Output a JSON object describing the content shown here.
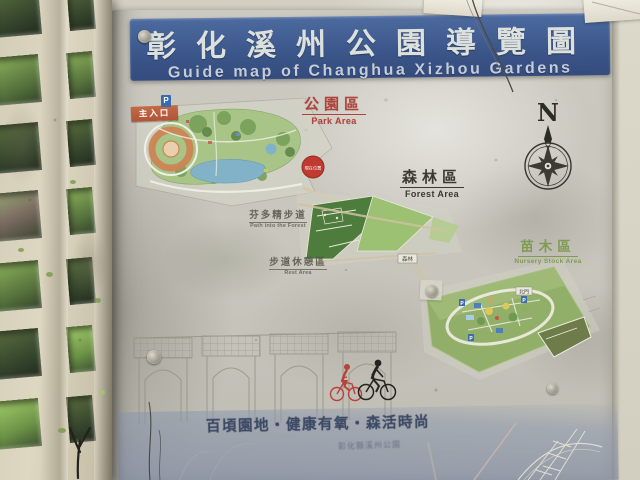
{
  "sign": {
    "title_zh": "彰化溪州公園導覽圖",
    "title_en": "Guide map of Changhua Xizhou Gardens"
  },
  "areas": {
    "park": {
      "zh": "公園區",
      "en": "Park Area"
    },
    "forest": {
      "zh": "森林區",
      "en": "Forest Area"
    },
    "nursery": {
      "zh": "苗木區",
      "en": "Nursery Stock Area"
    }
  },
  "labels": {
    "main_entrance": "主入口",
    "parking": "P",
    "north": "N",
    "you_are_here": "現在位置",
    "forest_box": "森林",
    "north_gate": "北門",
    "trail_zh": "芬多精步道",
    "trail_en": "Path into the Forest",
    "rest_zh": "步道休憩區",
    "rest_en": "Rest Area"
  },
  "footer": {
    "slogan": "百頃園地‧健康有氧‧森活時尚",
    "subtext": "彰化縣溪州公園"
  },
  "icons": {
    "compass_rose": "compass-rose-icon",
    "parking_badge": "parking-icon"
  },
  "colors": {
    "banner_blue": "#3e5b90",
    "park_label_red": "#ad453d",
    "forest_label_dark": "#3a3933",
    "nursery_label_green": "#7e9b50",
    "marker_red": "#c03a31",
    "band_blue_gray": "#8a96b0"
  }
}
